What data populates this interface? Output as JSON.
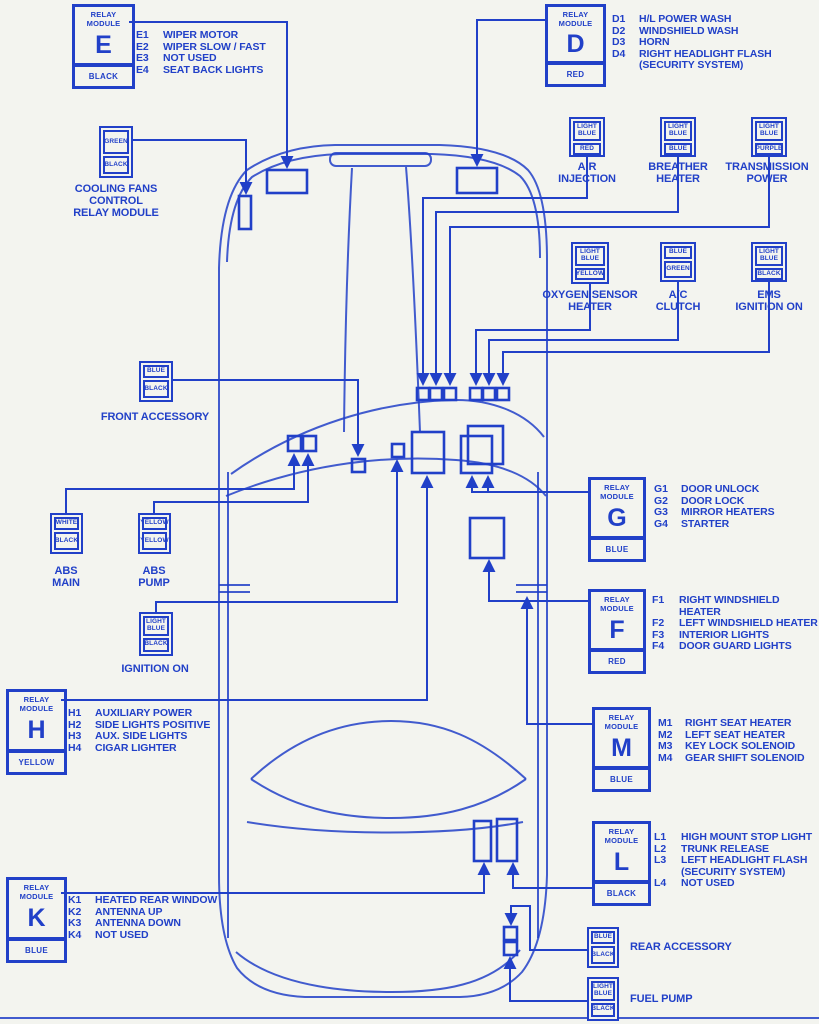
{
  "colors": {
    "ink": "#2140c8",
    "bg": "#f3f4ef"
  },
  "modules": {
    "E": {
      "header": "RELAY\nMODULE",
      "letter": "E",
      "tag": "BLACK",
      "items": [
        {
          "c": "E1",
          "t": "WIPER MOTOR"
        },
        {
          "c": "E2",
          "t": "WIPER SLOW / FAST"
        },
        {
          "c": "E3",
          "t": "NOT USED"
        },
        {
          "c": "E4",
          "t": "SEAT BACK LIGHTS"
        }
      ]
    },
    "D": {
      "header": "RELAY\nMODULE",
      "letter": "D",
      "tag": "RED",
      "items": [
        {
          "c": "D1",
          "t": "H/L POWER WASH"
        },
        {
          "c": "D2",
          "t": "WINDSHIELD WASH"
        },
        {
          "c": "D3",
          "t": "HORN"
        },
        {
          "c": "D4",
          "t": "RIGHT HEADLIGHT FLASH\n(SECURITY SYSTEM)"
        }
      ]
    },
    "G": {
      "header": "RELAY\nMODULE",
      "letter": "G",
      "tag": "BLUE",
      "items": [
        {
          "c": "G1",
          "t": "DOOR UNLOCK"
        },
        {
          "c": "G2",
          "t": "DOOR LOCK"
        },
        {
          "c": "G3",
          "t": "MIRROR HEATERS"
        },
        {
          "c": "G4",
          "t": "STARTER"
        }
      ]
    },
    "F": {
      "header": "RELAY\nMODULE",
      "letter": "F",
      "tag": "RED",
      "items": [
        {
          "c": "F1",
          "t": "RIGHT WINDSHIELD HEATER"
        },
        {
          "c": "F2",
          "t": "LEFT WINDSHIELD HEATER"
        },
        {
          "c": "F3",
          "t": "INTERIOR LIGHTS"
        },
        {
          "c": "F4",
          "t": "DOOR GUARD LIGHTS"
        }
      ]
    },
    "M": {
      "header": "RELAY\nMODULE",
      "letter": "M",
      "tag": "BLUE",
      "items": [
        {
          "c": "M1",
          "t": "RIGHT SEAT HEATER"
        },
        {
          "c": "M2",
          "t": "LEFT SEAT HEATER"
        },
        {
          "c": "M3",
          "t": "KEY LOCK SOLENOID"
        },
        {
          "c": "M4",
          "t": "GEAR SHIFT SOLENOID"
        }
      ]
    },
    "L": {
      "header": "RELAY\nMODULE",
      "letter": "L",
      "tag": "BLACK",
      "items": [
        {
          "c": "L1",
          "t": "HIGH MOUNT STOP LIGHT"
        },
        {
          "c": "L2",
          "t": "TRUNK RELEASE"
        },
        {
          "c": "L3",
          "t": "LEFT HEADLIGHT FLASH\n(SECURITY SYSTEM)"
        },
        {
          "c": "L4",
          "t": "NOT USED"
        }
      ]
    },
    "H": {
      "header": "RELAY\nMODULE",
      "letter": "H",
      "tag": "YELLOW",
      "items": [
        {
          "c": "H1",
          "t": "AUXILIARY POWER"
        },
        {
          "c": "H2",
          "t": "SIDE LIGHTS POSITIVE"
        },
        {
          "c": "H3",
          "t": "AUX. SIDE LIGHTS"
        },
        {
          "c": "H4",
          "t": "CIGAR LIGHTER"
        }
      ]
    },
    "K": {
      "header": "RELAY\nMODULE",
      "letter": "K",
      "tag": "BLUE",
      "items": [
        {
          "c": "K1",
          "t": "HEATED REAR WINDOW"
        },
        {
          "c": "K2",
          "t": "ANTENNA UP"
        },
        {
          "c": "K3",
          "t": "ANTENNA DOWN"
        },
        {
          "c": "K4",
          "t": "NOT USED"
        }
      ]
    }
  },
  "connectors": {
    "cooling": {
      "top": "GREEN",
      "bottom": "BLACK",
      "name": "COOLING FANS\nCONTROL\nRELAY MODULE"
    },
    "air": {
      "top": "LIGHT\nBLUE",
      "bottom": "RED",
      "name": "AIR\nINJECTION"
    },
    "breather": {
      "top": "LIGHT\nBLUE",
      "bottom": "BLUE",
      "name": "BREATHER\nHEATER"
    },
    "transmission": {
      "top": "LIGHT\nBLUE",
      "bottom": "PURPLE",
      "name": "TRANSMISSION\nPOWER"
    },
    "oxygen": {
      "top": "LIGHT\nBLUE",
      "bottom": "YELLOW",
      "name": "OXYGEN SENSOR\nHEATER"
    },
    "ac": {
      "top": "BLUE",
      "bottom": "GREEN",
      "name": "A/C\nCLUTCH"
    },
    "ems": {
      "top": "LIGHT\nBLUE",
      "bottom": "BLACK",
      "name": "EMS\nIGNITION ON"
    },
    "front_accessory": {
      "top": "BLUE",
      "bottom": "BLACK",
      "name": "FRONT ACCESSORY"
    },
    "abs_main": {
      "top": "WHITE",
      "bottom": "BLACK",
      "name": "ABS\nMAIN"
    },
    "abs_pump": {
      "top": "YELLOW",
      "bottom": "YELLOW",
      "name": "ABS\nPUMP"
    },
    "ignition_on": {
      "top": "LIGHT\nBLUE",
      "bottom": "BLACK",
      "name": "IGNITION ON"
    },
    "rear_accessory": {
      "top": "BLUE",
      "bottom": "BLACK",
      "name": "REAR ACCESSORY"
    },
    "fuel_pump": {
      "top": "LIGHT\nBLUE",
      "bottom": "BLACK",
      "name": "FUEL PUMP"
    }
  }
}
